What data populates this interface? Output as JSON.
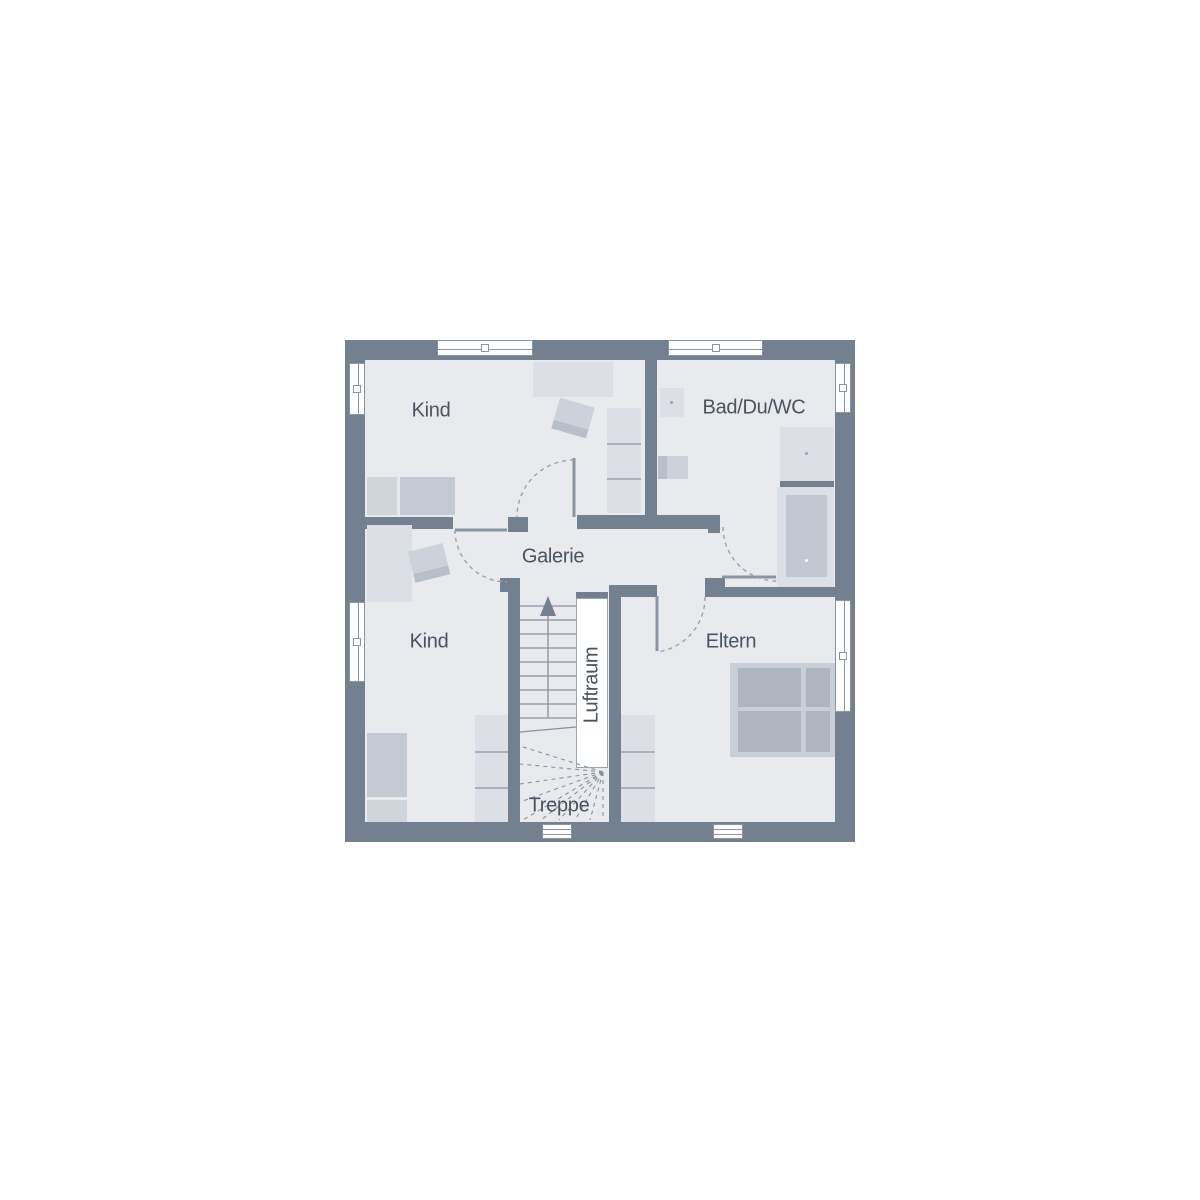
{
  "plan": {
    "title": "Obergeschoss Grundriss",
    "labels": {
      "kind1": "Kind",
      "bad": "Bad/Du/WC",
      "galerie": "Galerie",
      "kind2": "Kind",
      "eltern": "Eltern",
      "luftraum": "Luftraum",
      "treppe": "Treppe"
    },
    "colors": {
      "background": "#ffffff",
      "wall": "#72808f",
      "floor": "#e8eaee",
      "f1": "#dcdfe5",
      "f2": "#ccd2da",
      "f3": "#b8bfcb",
      "window_line": "#8a95a3",
      "text": "#4a5362",
      "dashed": "#98a1ad",
      "stair_line": "#8792a1"
    }
  }
}
